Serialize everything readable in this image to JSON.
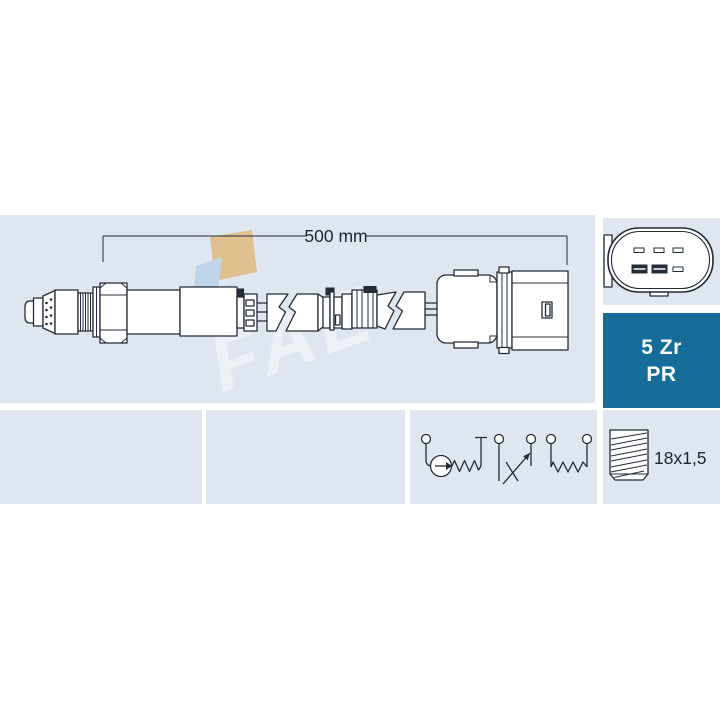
{
  "title": "Lambda sensor technical drawing",
  "colors": {
    "panel_bg": "#dfe6f0",
    "badge_bg": "#176d99",
    "badge_text": "#ffffff",
    "outline": "#232b38",
    "watermark_tan": "#e0b97e",
    "watermark_blue": "#b9d2ea"
  },
  "dimension": {
    "label": "500 mm"
  },
  "badge": {
    "line1": "5 Zr",
    "line2": "PR"
  },
  "thread": {
    "label": "18x1,5"
  },
  "watermark": {
    "text": "FAE"
  },
  "connector_pinout": {
    "top_pins": 3,
    "bottom_pins": 3,
    "filled_pins": 2
  },
  "circuit": {
    "terminals": 5,
    "elements": [
      "pump-cell",
      "trim-resistor",
      "heater-resistor"
    ]
  }
}
